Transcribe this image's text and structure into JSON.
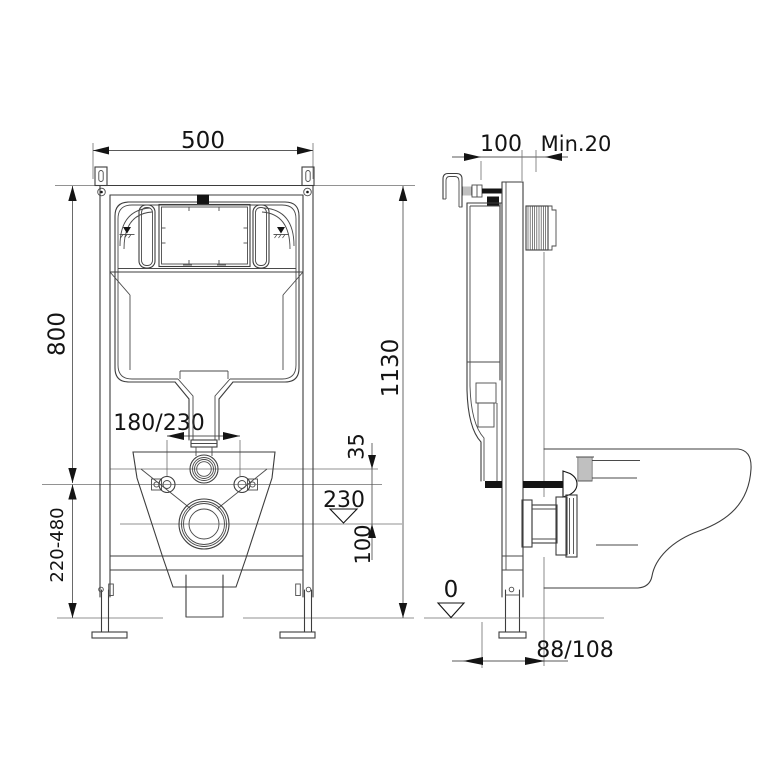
{
  "dims": {
    "front": {
      "width": "500",
      "frame_height": "800",
      "total_height": "1130",
      "leg_range": "220-480",
      "bolt_spacing": "180/230",
      "flush_offset": "35",
      "drain_height": "230",
      "drain_to_bolts": "100"
    },
    "side": {
      "depth": "100",
      "min_wall": "Min.20",
      "floor_level": "0",
      "drain_offset": "88/108"
    }
  },
  "icons": {
    "water_level_icon": "filled triangle over hatched line",
    "datum_triangle_icon": "open triangle level marker"
  },
  "colors": {
    "line": "#3d3d3d",
    "dim_line": "#5a5a5a",
    "ink": "#141414",
    "background": "#ffffff"
  }
}
